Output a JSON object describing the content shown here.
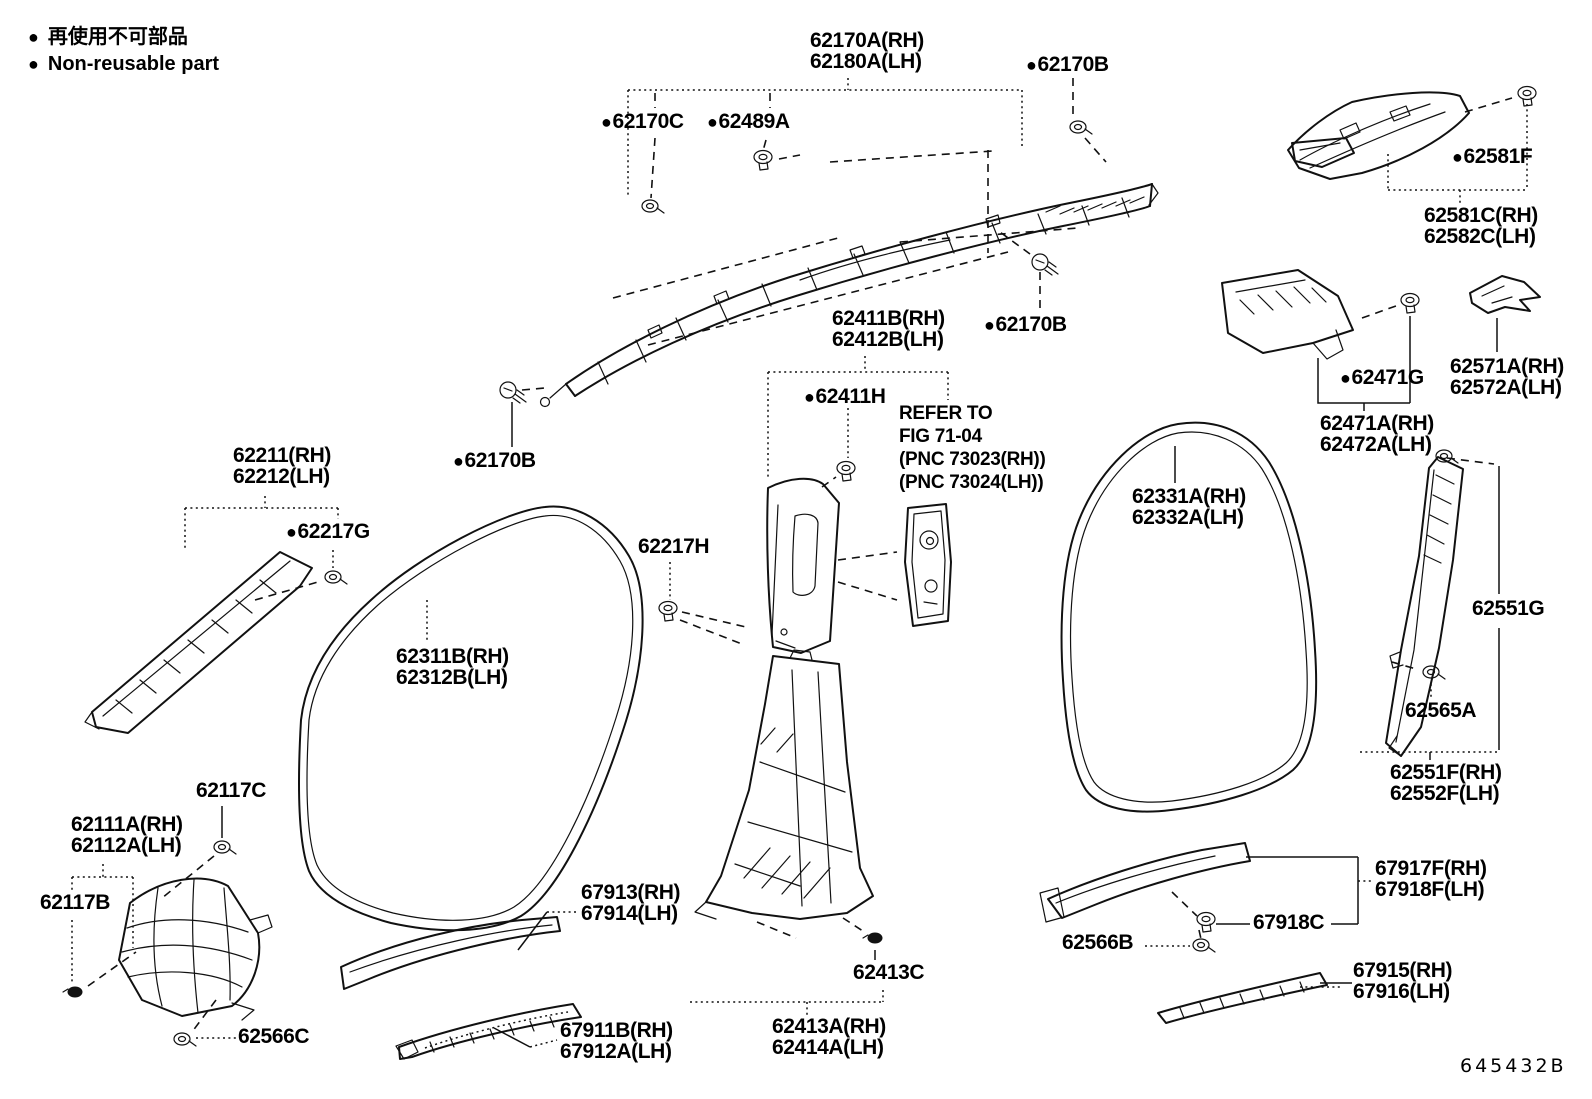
{
  "legend": {
    "bullet": "●",
    "jp": "再使用不可部品",
    "en": "Non-reusable part"
  },
  "diagram_code": "645432B",
  "note": {
    "lines": [
      "REFER TO",
      "FIG 71-04",
      "(PNC 73023(RH))",
      "(PNC 73024(LH))"
    ]
  },
  "colors": {
    "line": "#111111",
    "background": "#ffffff"
  },
  "labels": [
    {
      "id": "62170a",
      "lines": [
        "62170A(RH)",
        "62180A(LH)"
      ],
      "bullet": false,
      "x": 810,
      "y": 30
    },
    {
      "id": "62170b-top",
      "lines": [
        "62170B"
      ],
      "bullet": true,
      "x": 1026,
      "y": 54
    },
    {
      "id": "62170c",
      "lines": [
        "62170C"
      ],
      "bullet": true,
      "x": 601,
      "y": 111
    },
    {
      "id": "62489a",
      "lines": [
        "62489A"
      ],
      "bullet": true,
      "x": 707,
      "y": 111
    },
    {
      "id": "62581f",
      "lines": [
        "62581F"
      ],
      "bullet": true,
      "x": 1452,
      "y": 146
    },
    {
      "id": "62581c",
      "lines": [
        "62581C(RH)",
        "62582C(LH)"
      ],
      "bullet": false,
      "x": 1424,
      "y": 205
    },
    {
      "id": "62411b",
      "lines": [
        "62411B(RH)",
        "62412B(LH)"
      ],
      "bullet": false,
      "x": 832,
      "y": 308
    },
    {
      "id": "62170b-mid",
      "lines": [
        "62170B"
      ],
      "bullet": true,
      "x": 984,
      "y": 314
    },
    {
      "id": "62411h",
      "lines": [
        "62411H"
      ],
      "bullet": true,
      "x": 804,
      "y": 386
    },
    {
      "id": "refer-note",
      "lines": [
        "REFER TO",
        "FIG 71-04",
        "(PNC 73023(RH))",
        "(PNC 73024(LH))"
      ],
      "bullet": false,
      "x": 899,
      "y": 402,
      "cls": "small"
    },
    {
      "id": "62211",
      "lines": [
        "62211(RH)",
        "62212(LH)"
      ],
      "bullet": false,
      "x": 233,
      "y": 445
    },
    {
      "id": "62170b-left",
      "lines": [
        "62170B"
      ],
      "bullet": true,
      "x": 453,
      "y": 450
    },
    {
      "id": "62217g",
      "lines": [
        "62217G"
      ],
      "bullet": true,
      "x": 286,
      "y": 521
    },
    {
      "id": "62217h",
      "lines": [
        "62217H"
      ],
      "bullet": false,
      "x": 638,
      "y": 536
    },
    {
      "id": "62311b",
      "lines": [
        "62311B(RH)",
        "62312B(LH)"
      ],
      "bullet": false,
      "x": 396,
      "y": 646
    },
    {
      "id": "62331a",
      "lines": [
        "62331A(RH)",
        "62332A(LH)"
      ],
      "bullet": false,
      "x": 1132,
      "y": 486
    },
    {
      "id": "62571a",
      "lines": [
        "62571A(RH)",
        "62572A(LH)"
      ],
      "bullet": false,
      "x": 1450,
      "y": 356
    },
    {
      "id": "62471g",
      "lines": [
        "62471G"
      ],
      "bullet": true,
      "x": 1340,
      "y": 367
    },
    {
      "id": "62471a",
      "lines": [
        "62471A(RH)",
        "62472A(LH)"
      ],
      "bullet": false,
      "x": 1320,
      "y": 413
    },
    {
      "id": "62551g",
      "lines": [
        "62551G"
      ],
      "bullet": false,
      "x": 1470,
      "y": 598,
      "cls": "onwhite"
    },
    {
      "id": "62565a",
      "lines": [
        "62565A"
      ],
      "bullet": false,
      "x": 1405,
      "y": 700
    },
    {
      "id": "62551f",
      "lines": [
        "62551F(RH)",
        "62552F(LH)"
      ],
      "bullet": false,
      "x": 1390,
      "y": 762
    },
    {
      "id": "62117c",
      "lines": [
        "62117C"
      ],
      "bullet": false,
      "x": 196,
      "y": 780
    },
    {
      "id": "62111a",
      "lines": [
        "62111A(RH)",
        "62112A(LH)"
      ],
      "bullet": false,
      "x": 71,
      "y": 814
    },
    {
      "id": "62117b",
      "lines": [
        "62117B"
      ],
      "bullet": false,
      "x": 40,
      "y": 892
    },
    {
      "id": "62566c",
      "lines": [
        "62566C"
      ],
      "bullet": false,
      "x": 238,
      "y": 1026
    },
    {
      "id": "67913",
      "lines": [
        "67913(RH)",
        "67914(LH)"
      ],
      "bullet": false,
      "x": 581,
      "y": 882
    },
    {
      "id": "67911b",
      "lines": [
        "67911B(RH)",
        "67912A(LH)"
      ],
      "bullet": false,
      "x": 560,
      "y": 1020
    },
    {
      "id": "62413c",
      "lines": [
        "62413C"
      ],
      "bullet": false,
      "x": 853,
      "y": 962
    },
    {
      "id": "62413a",
      "lines": [
        "62413A(RH)",
        "62414A(LH)"
      ],
      "bullet": false,
      "x": 772,
      "y": 1016
    },
    {
      "id": "62566b",
      "lines": [
        "62566B"
      ],
      "bullet": false,
      "x": 1062,
      "y": 932
    },
    {
      "id": "67918c",
      "lines": [
        "67918C"
      ],
      "bullet": false,
      "x": 1253,
      "y": 912
    },
    {
      "id": "67917f",
      "lines": [
        "67917F(RH)",
        "67918F(LH)"
      ],
      "bullet": false,
      "x": 1375,
      "y": 858
    },
    {
      "id": "67915",
      "lines": [
        "67915(RH)",
        "67916(LH)"
      ],
      "bullet": false,
      "x": 1353,
      "y": 960
    },
    {
      "id": "diagram-code",
      "lines": [
        "645432B"
      ],
      "bullet": false,
      "x": 1460,
      "y": 1056,
      "cls": "code"
    }
  ]
}
